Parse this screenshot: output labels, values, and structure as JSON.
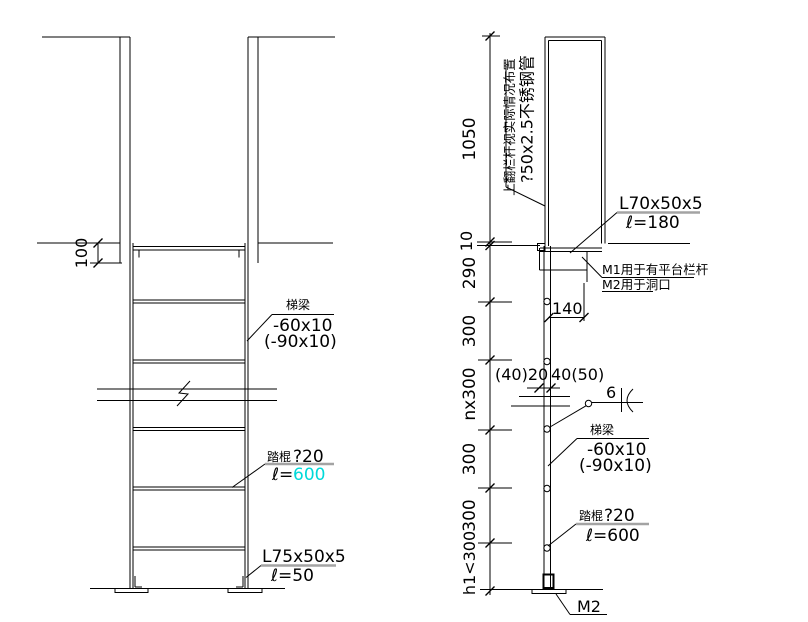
{
  "front_view": {
    "dim_offset": "100",
    "beam_label": {
      "name": "梯梁",
      "size": "-60x10",
      "alt_size": "(-90x10)"
    },
    "rung_label": {
      "name": "踏棍",
      "dia": "?20",
      "len_prefix": "ℓ=",
      "len_value": "600"
    },
    "shoe_label": {
      "size": "L75x50x5",
      "len": "ℓ=50"
    }
  },
  "side_view": {
    "dims": [
      "1050",
      "10",
      "290",
      "300",
      "nx300",
      "300",
      "300",
      "h1<300"
    ],
    "dim_width_top": "140",
    "dim_hole_left": "(40)20",
    "dim_hole_right": "40(50)",
    "weld_size": "6",
    "rail_note": {
      "line1": "上翻栏杆视实际情况布置",
      "line2": "?50x2.5不锈钢管"
    },
    "angle_label": {
      "size": "L70x50x5",
      "len": "ℓ=180"
    },
    "usage_note": {
      "line1": "M1用于有平台栏杆",
      "line2": "M2用于洞口"
    },
    "beam_label": {
      "name": "梯梁",
      "size": "-60x10",
      "alt_size": "(-90x10)"
    },
    "rung_label": {
      "name": "踏棍",
      "dia": "?20",
      "len": "ℓ=600"
    },
    "base_label": "M2"
  },
  "colors": {
    "line": "#000000",
    "highlight": "#00d9d9",
    "underline_gray": "#a3a3a3"
  }
}
